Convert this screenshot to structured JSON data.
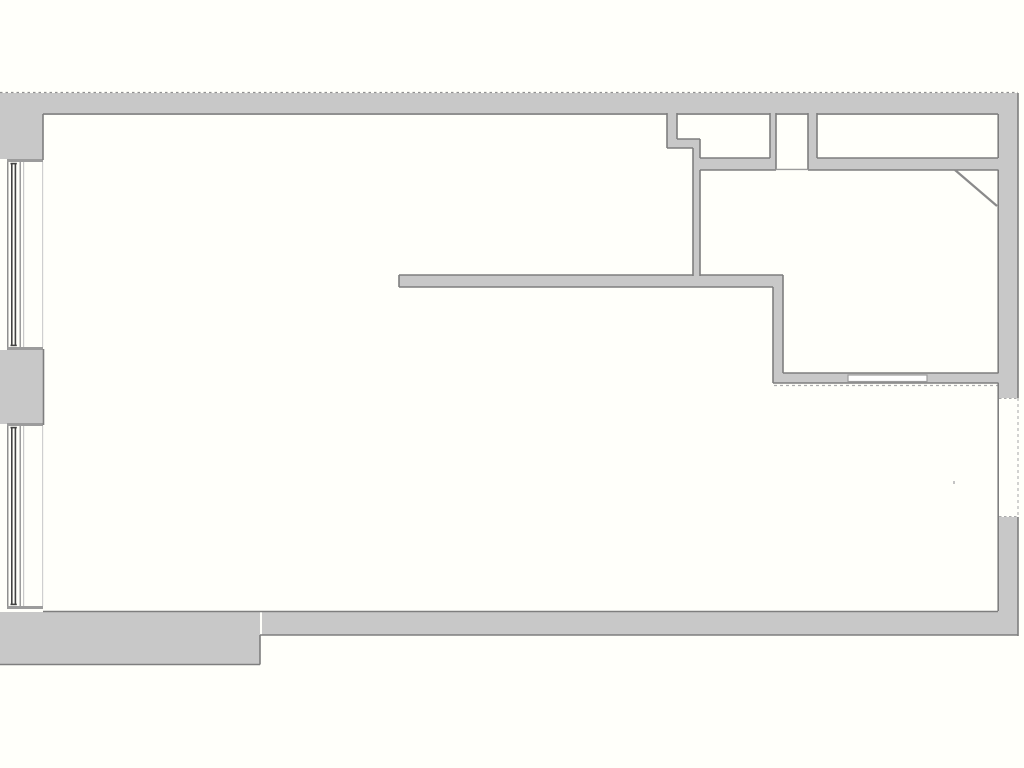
{
  "plan": {
    "canvas": {
      "width": 1024,
      "height": 768,
      "background": "#fffffa"
    },
    "colors": {
      "wall_fill": "#c8c8c8",
      "wall_outline": "#7e7e7e",
      "sill_gray": "#9c9c9c",
      "glass_dark": "#424242",
      "light_line": "#c8c8c8",
      "dashed_line": "#ababab",
      "paper": "#fffffa"
    },
    "rects": [
      {
        "name": "top-exterior-wall",
        "x": 0,
        "y": 93,
        "w": 1018,
        "h": 22,
        "fill": "#c8c8c8"
      },
      {
        "name": "left-wall-pier-top",
        "x": 0,
        "y": 93,
        "w": 43,
        "h": 66,
        "fill": "#c8c8c8"
      },
      {
        "name": "left-wall-pier-middle",
        "x": 0,
        "y": 350,
        "w": 44,
        "h": 74,
        "fill": "#c8c8c8"
      },
      {
        "name": "right-exterior-wall-upper",
        "x": 998,
        "y": 93,
        "w": 20,
        "h": 305,
        "fill": "#c8c8c8"
      },
      {
        "name": "right-exterior-wall-lower",
        "x": 998,
        "y": 517,
        "w": 20,
        "h": 95,
        "fill": "#c8c8c8"
      },
      {
        "name": "bottom-exterior-wall",
        "x": 262,
        "y": 612,
        "w": 756,
        "h": 23,
        "fill": "#c8c8c8"
      },
      {
        "name": "bottom-exterior-wall-thick",
        "x": 0,
        "y": 612,
        "w": 260,
        "h": 53,
        "fill": "#c8c8c8"
      },
      {
        "name": "room-a-wall-stub",
        "x": 667,
        "y": 113,
        "w": 10,
        "h": 35,
        "fill": "#c8c8c8"
      },
      {
        "name": "room-a-wall-step",
        "x": 667,
        "y": 139,
        "w": 33,
        "h": 9,
        "fill": "#c8c8c8"
      },
      {
        "name": "center-vertical-wall",
        "x": 693,
        "y": 139,
        "w": 7,
        "h": 148,
        "fill": "#c8c8c8"
      },
      {
        "name": "rooms-bottom-wall-left",
        "x": 693,
        "y": 158,
        "w": 83,
        "h": 12,
        "fill": "#c8c8c8"
      },
      {
        "name": "wall-between-room-a-b",
        "x": 770,
        "y": 113,
        "w": 6,
        "h": 57,
        "fill": "#c8c8c8"
      },
      {
        "name": "wall-between-room-b-c",
        "x": 808,
        "y": 113,
        "w": 9,
        "h": 57,
        "fill": "#c8c8c8"
      },
      {
        "name": "rooms-bottom-wall-right",
        "x": 808,
        "y": 158,
        "w": 190,
        "h": 12,
        "fill": "#c8c8c8"
      },
      {
        "name": "main-interior-wall",
        "x": 399,
        "y": 275,
        "w": 384,
        "h": 12,
        "fill": "#c8c8c8"
      },
      {
        "name": "mid-vertical-wall",
        "x": 773,
        "y": 275,
        "w": 10,
        "h": 108,
        "fill": "#c8c8c8"
      },
      {
        "name": "lower-interior-wall",
        "x": 783,
        "y": 373,
        "w": 215,
        "h": 10,
        "fill": "#c8c8c8"
      },
      {
        "name": "window1-top-sill",
        "x": 7,
        "y": 159,
        "w": 36,
        "h": 3,
        "fill": "#9c9c9c"
      },
      {
        "name": "window1-bottom-sill",
        "x": 7,
        "y": 347,
        "w": 36,
        "h": 3,
        "fill": "#9c9c9c"
      },
      {
        "name": "window2-top-sill",
        "x": 7,
        "y": 423,
        "w": 36,
        "h": 3,
        "fill": "#9c9c9c"
      },
      {
        "name": "window2-bottom-sill",
        "x": 7,
        "y": 606,
        "w": 36,
        "h": 3,
        "fill": "#9c9c9c"
      },
      {
        "name": "window1-outer-frame-line",
        "x": 7,
        "y": 162,
        "w": 1.5,
        "h": 185,
        "fill": "#8f8f8f"
      },
      {
        "name": "window1-glass-line-1",
        "x": 11,
        "y": 163,
        "w": 1.6,
        "h": 183,
        "fill": "#424242"
      },
      {
        "name": "window1-glass-line-2",
        "x": 14.6,
        "y": 163,
        "w": 1.6,
        "h": 183,
        "fill": "#424242"
      },
      {
        "name": "window1-glass-cap-top",
        "x": 10.5,
        "y": 162.8,
        "w": 6.3,
        "h": 1.6,
        "fill": "#424242"
      },
      {
        "name": "window1-glass-cap-bottom",
        "x": 10.5,
        "y": 344.6,
        "w": 6.3,
        "h": 1.6,
        "fill": "#424242"
      },
      {
        "name": "window1-inner-frame-line",
        "x": 19.5,
        "y": 162,
        "w": 1.5,
        "h": 185,
        "fill": "#9c9c9c"
      },
      {
        "name": "window1-sill-edge-line",
        "x": 23,
        "y": 162,
        "w": 1.2,
        "h": 185,
        "fill": "#c8c8c8"
      },
      {
        "name": "window1-interior-face-line",
        "x": 42,
        "y": 162,
        "w": 1.2,
        "h": 185,
        "fill": "#cfcfcf"
      },
      {
        "name": "window2-outer-frame-line",
        "x": 7,
        "y": 426,
        "w": 1.5,
        "h": 180,
        "fill": "#8f8f8f"
      },
      {
        "name": "window2-glass-line-1",
        "x": 11,
        "y": 427,
        "w": 1.6,
        "h": 178,
        "fill": "#424242"
      },
      {
        "name": "window2-glass-line-2",
        "x": 14.6,
        "y": 427,
        "w": 1.6,
        "h": 178,
        "fill": "#424242"
      },
      {
        "name": "window2-glass-cap-top",
        "x": 10.5,
        "y": 426.8,
        "w": 6.3,
        "h": 1.6,
        "fill": "#424242"
      },
      {
        "name": "window2-glass-cap-bottom",
        "x": 10.5,
        "y": 603.6,
        "w": 6.3,
        "h": 1.6,
        "fill": "#424242"
      },
      {
        "name": "window2-inner-frame-line",
        "x": 19.5,
        "y": 426,
        "w": 1.5,
        "h": 180,
        "fill": "#9c9c9c"
      },
      {
        "name": "window2-sill-edge-line",
        "x": 23,
        "y": 426,
        "w": 1.2,
        "h": 180,
        "fill": "#c8c8c8"
      },
      {
        "name": "window2-interior-face-line",
        "x": 42,
        "y": 426,
        "w": 1.2,
        "h": 180,
        "fill": "#cfcfcf"
      },
      {
        "name": "interior-wall-opening",
        "x": 848,
        "y": 375,
        "w": 79,
        "h": 6.5,
        "fill": "#ffffff",
        "stroke": "#9c9c9c",
        "sw": 1.2
      },
      {
        "name": "plan-speck",
        "x": 953,
        "y": 481,
        "w": 2,
        "h": 3,
        "fill": "#c4c4c4"
      }
    ],
    "lines": [
      {
        "name": "top-wall-outer-edge-dashed",
        "x1": 0,
        "y1": 92.5,
        "x2": 1018,
        "y2": 92.5,
        "color": "#909090",
        "w": 1.3,
        "dash": "2.5,3"
      },
      {
        "name": "top-wall-inner-edge-1",
        "x1": 43,
        "y1": 114,
        "x2": 667,
        "y2": 114
      },
      {
        "name": "top-wall-inner-edge-2",
        "x1": 677,
        "y1": 114,
        "x2": 770,
        "y2": 114
      },
      {
        "name": "top-wall-inner-edge-3",
        "x1": 776,
        "y1": 114,
        "x2": 808,
        "y2": 114
      },
      {
        "name": "top-wall-inner-edge-4",
        "x1": 817,
        "y1": 114,
        "x2": 998,
        "y2": 114
      },
      {
        "name": "left-pier-top-inner-face",
        "x1": 43,
        "y1": 114,
        "x2": 43,
        "y2": 160
      },
      {
        "name": "left-pier-mid-inner-face",
        "x1": 43.5,
        "y1": 349,
        "x2": 43.5,
        "y2": 425
      },
      {
        "name": "room-a-stub-left-face",
        "x1": 667,
        "y1": 113,
        "x2": 667,
        "y2": 148
      },
      {
        "name": "room-a-stub-right-face",
        "x1": 677,
        "y1": 113,
        "x2": 677,
        "y2": 139
      },
      {
        "name": "room-a-step-bottom-edge",
        "x1": 667,
        "y1": 148,
        "x2": 693,
        "y2": 148
      },
      {
        "name": "room-a-step-top-edge",
        "x1": 677,
        "y1": 139,
        "x2": 700,
        "y2": 139
      },
      {
        "name": "center-wall-right-face-upper",
        "x1": 700,
        "y1": 139,
        "x2": 700,
        "y2": 158
      },
      {
        "name": "center-wall-left-face",
        "x1": 693,
        "y1": 148,
        "x2": 693,
        "y2": 276
      },
      {
        "name": "center-wall-right-face-lower",
        "x1": 700,
        "y1": 170,
        "x2": 700,
        "y2": 276
      },
      {
        "name": "room-a-bottom-edge",
        "x1": 700,
        "y1": 158,
        "x2": 770,
        "y2": 158
      },
      {
        "name": "rooms-band-left-bottom-edge",
        "x1": 700,
        "y1": 170,
        "x2": 776,
        "y2": 170
      },
      {
        "name": "wall-ab-left-face",
        "x1": 770,
        "y1": 113,
        "x2": 770,
        "y2": 158
      },
      {
        "name": "wall-ab-right-face",
        "x1": 776,
        "y1": 113,
        "x2": 776,
        "y2": 169
      },
      {
        "name": "room-b-threshold-line",
        "x1": 776,
        "y1": 169.4,
        "x2": 808,
        "y2": 169.4,
        "color": "#9c9c9c",
        "w": 1.4
      },
      {
        "name": "wall-bc-left-face",
        "x1": 808,
        "y1": 113,
        "x2": 808,
        "y2": 169
      },
      {
        "name": "wall-bc-right-face",
        "x1": 817,
        "y1": 113,
        "x2": 817,
        "y2": 158
      },
      {
        "name": "room-c-bottom-edge",
        "x1": 817,
        "y1": 158,
        "x2": 998,
        "y2": 158
      },
      {
        "name": "rooms-band-right-bottom-edge",
        "x1": 808,
        "y1": 170,
        "x2": 998.5,
        "y2": 170
      },
      {
        "name": "main-wall-top-edge-left",
        "x1": 399,
        "y1": 275,
        "x2": 693,
        "y2": 275
      },
      {
        "name": "main-wall-top-edge-right",
        "x1": 700,
        "y1": 275,
        "x2": 783,
        "y2": 275
      },
      {
        "name": "main-wall-end-cap",
        "x1": 399,
        "y1": 275,
        "x2": 399,
        "y2": 287
      },
      {
        "name": "main-wall-bottom-edge",
        "x1": 399,
        "y1": 287,
        "x2": 773,
        "y2": 287
      },
      {
        "name": "mid-wall-left-face",
        "x1": 773,
        "y1": 287,
        "x2": 773,
        "y2": 383
      },
      {
        "name": "mid-wall-right-face",
        "x1": 783,
        "y1": 275,
        "x2": 783,
        "y2": 373
      },
      {
        "name": "lower-wall-top-edge",
        "x1": 783,
        "y1": 373,
        "x2": 998.5,
        "y2": 373
      },
      {
        "name": "lower-wall-bottom-edge",
        "x1": 773,
        "y1": 383,
        "x2": 998.5,
        "y2": 383
      },
      {
        "name": "lower-wall-dashed-line",
        "x1": 774,
        "y1": 385.5,
        "x2": 998,
        "y2": 385.5,
        "color": "#ababab",
        "w": 1.2,
        "dash": "3,3"
      },
      {
        "name": "right-wall-inner-face-1",
        "x1": 998.2,
        "y1": 114,
        "x2": 998.2,
        "y2": 158
      },
      {
        "name": "right-wall-inner-face-2",
        "x1": 998.2,
        "y1": 170,
        "x2": 998.2,
        "y2": 373
      },
      {
        "name": "right-wall-inner-face-3",
        "x1": 998.2,
        "y1": 383,
        "x2": 998.2,
        "y2": 611
      },
      {
        "name": "right-wall-outer-face-upper",
        "x1": 1018,
        "y1": 93,
        "x2": 1018,
        "y2": 398
      },
      {
        "name": "right-wall-gap-outer-dashed",
        "x1": 1018,
        "y1": 398,
        "x2": 1018,
        "y2": 517,
        "color": "#b5b5b5",
        "w": 1.2,
        "dash": "3,3"
      },
      {
        "name": "right-wall-outer-face-lower",
        "x1": 1018,
        "y1": 517,
        "x2": 1018,
        "y2": 636
      },
      {
        "name": "right-wall-gap-top-dashed",
        "x1": 999,
        "y1": 398.5,
        "x2": 1018,
        "y2": 398.5,
        "color": "#aaaaaa",
        "w": 1.1,
        "dash": "2.5,2.5"
      },
      {
        "name": "right-wall-gap-bottom-dashed",
        "x1": 999,
        "y1": 516.5,
        "x2": 1018,
        "y2": 516.5,
        "color": "#aaaaaa",
        "w": 1.1,
        "dash": "2.5,2.5"
      },
      {
        "name": "bottom-wall-inner-edge",
        "x1": 43,
        "y1": 611.5,
        "x2": 998,
        "y2": 611.5
      },
      {
        "name": "bottom-wall-thick-outer-edge",
        "x1": 0,
        "y1": 664.5,
        "x2": 260,
        "y2": 664.5
      },
      {
        "name": "bottom-wall-step-face",
        "x1": 260,
        "y1": 635,
        "x2": 260,
        "y2": 664.5
      },
      {
        "name": "bottom-wall-outer-edge",
        "x1": 260,
        "y1": 635,
        "x2": 1017.5,
        "y2": 635
      },
      {
        "name": "corner-diagonal-partition",
        "x1": 955,
        "y1": 170,
        "x2": 997,
        "y2": 206,
        "color": "#8a8a8a",
        "w": 2.2
      }
    ]
  }
}
